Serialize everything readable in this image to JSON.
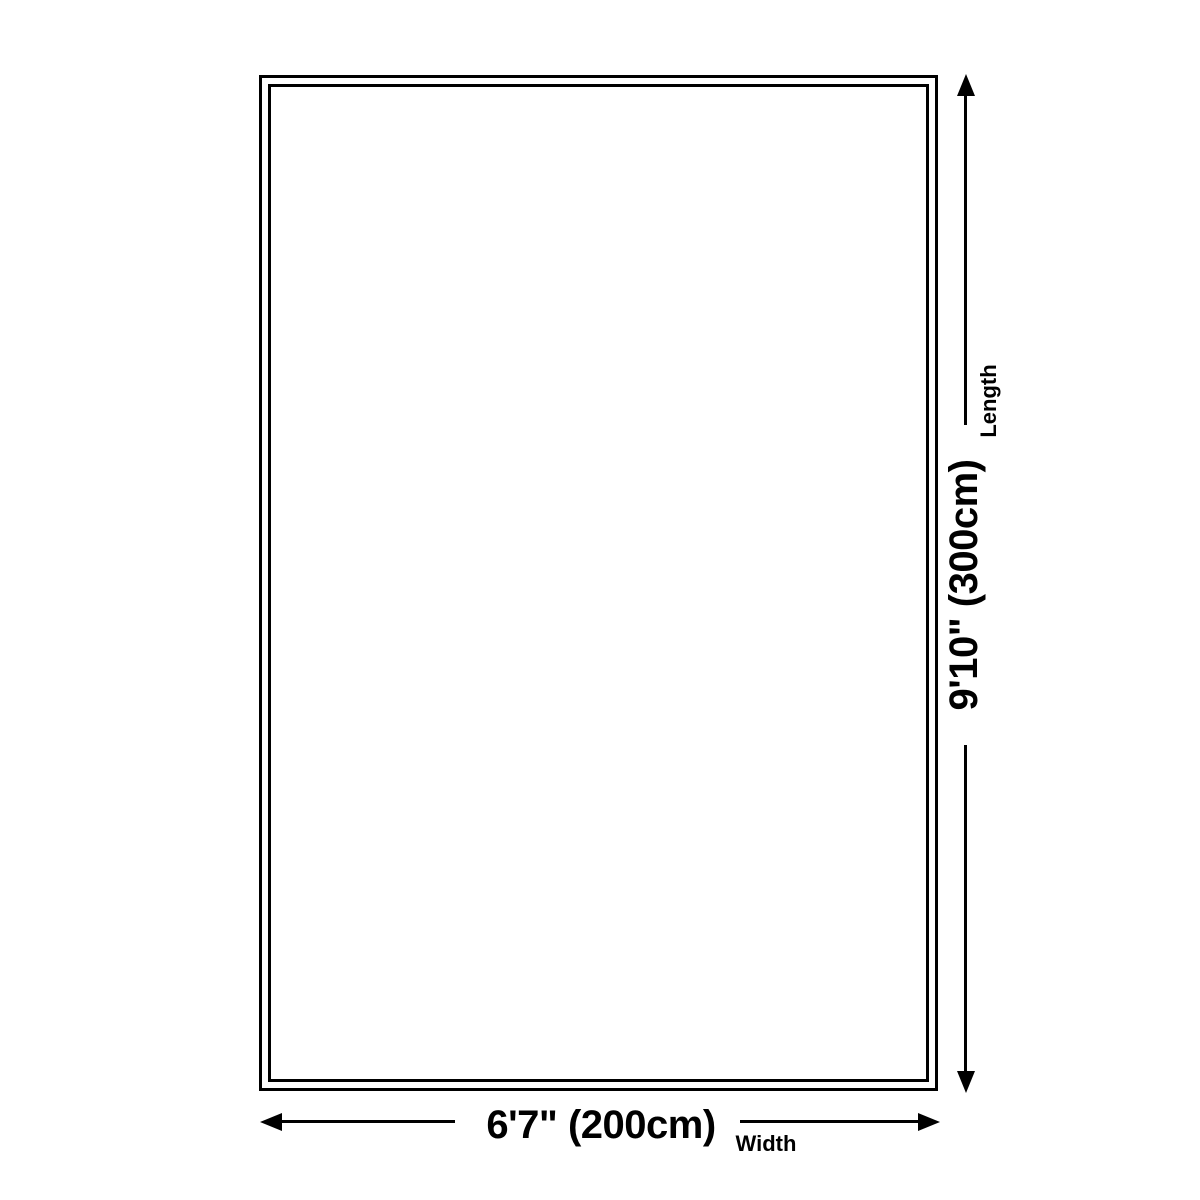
{
  "diagram": {
    "kind": "size-dimension-diagram",
    "colors": {
      "background": "#ffffff",
      "line": "#000000",
      "text": "#000000"
    },
    "width_dimension": {
      "value": "6'7\" (200cm)",
      "caption": "Width"
    },
    "length_dimension": {
      "value": "9'10\" (300cm)",
      "caption": "Length"
    }
  }
}
